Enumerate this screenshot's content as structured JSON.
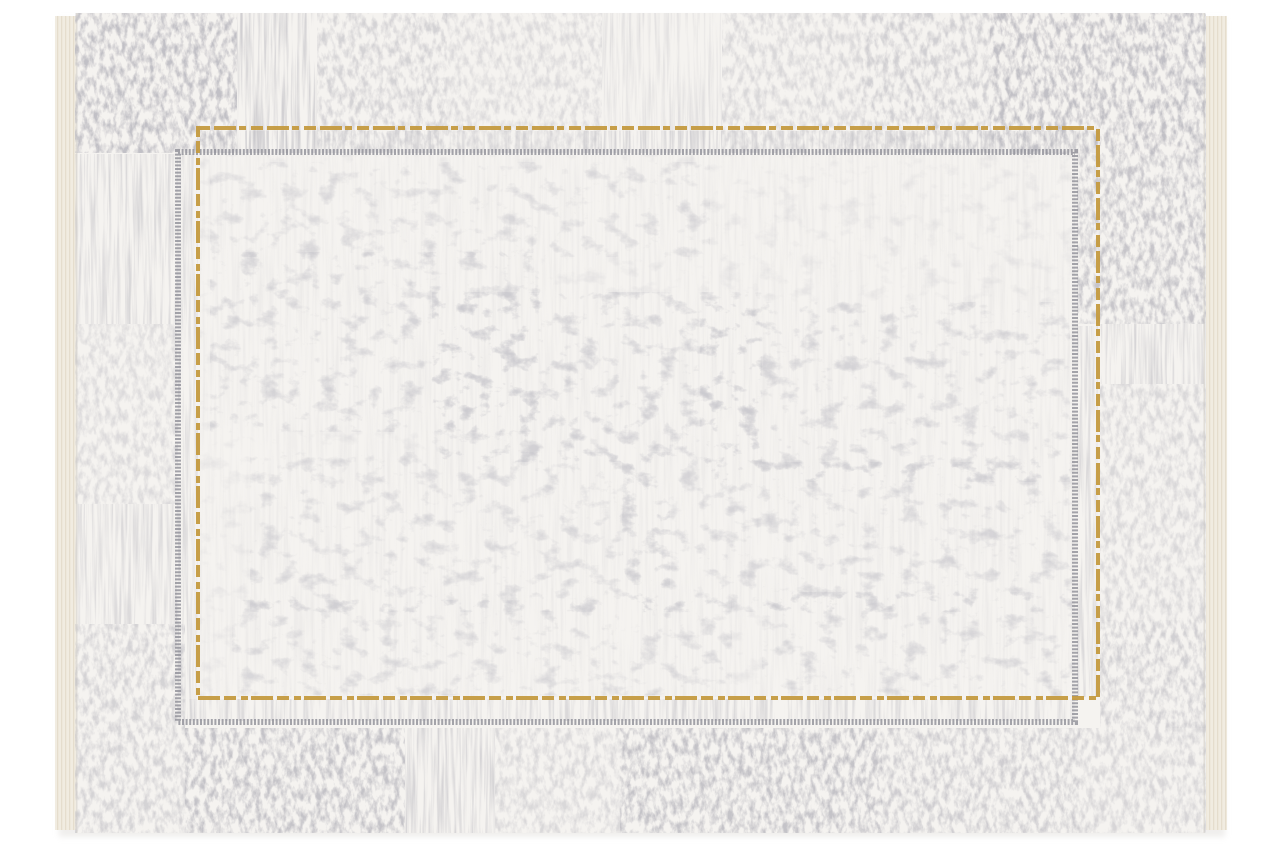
{
  "image": {
    "description": "Product photograph of a modern distressed-style area rug on a white background. Cream-white rug with abstract faded grey patchwork border texture, an inner field framed by a thin dashed gold rectangle and an offset dashed grey rectangle, with cream fringe selvedge bands on the left and right edges.",
    "width": 1280,
    "height": 853,
    "background_color": "#ffffff"
  },
  "palette": {
    "rug_base": "#f5f3f0",
    "field_base": "#f3f1ee",
    "fringe_cream": "#f1ece1",
    "fringe_rib": "#e2dac8",
    "edge_seam": "#dcd8d2",
    "texture_grey_dark": "#85838c",
    "texture_grey_mid": "#8a8890",
    "texture_grey_light": "#94929b",
    "gold_accent": "#c49a3f",
    "grey_frame": "#8f8f97",
    "shadow": "#e3e1de"
  },
  "rug": {
    "x": 55,
    "y": 13,
    "width": 1172,
    "height": 820,
    "pile": {
      "x": 76,
      "y": 13,
      "width": 1129,
      "height": 820,
      "base_color": "#f5f3f0"
    },
    "fringe": {
      "left_x": 55,
      "right_x": 1206,
      "width": 21,
      "y": 16,
      "height": 814,
      "color": "#f1ece1",
      "rib_color": "#e2dac8"
    },
    "seam_color": "#dcd8d2",
    "frames": {
      "gold": {
        "x": 198,
        "y": 128,
        "width": 900,
        "height": 570,
        "stroke_width": 4,
        "color": "#c49a3f",
        "dash": "12 4 22 3 7 5",
        "opacity": 0.95
      },
      "grey": {
        "x": 178,
        "y": 152,
        "width": 897,
        "height": 570,
        "stroke_width": 6,
        "color": "#8f8f97",
        "dash": "2 1.6",
        "opacity": 0.8
      }
    },
    "textures": {
      "threads": {
        "base_frequency": "0.35 0.012",
        "octaves": 3,
        "seed": 11,
        "color": "#8a8890",
        "alpha_gain": 2.6,
        "alpha_bias": -1.05
      },
      "cross": {
        "base_frequency": "0.18 0.09",
        "octaves": 4,
        "seed": 7,
        "color": "#85838c",
        "alpha_gain": 2.8,
        "alpha_bias": -1.1
      },
      "speck": {
        "base_frequency": "0.05 0.07",
        "octaves": 5,
        "seed": 3,
        "color": "#94929b",
        "alpha_gain": 3.5,
        "alpha_bias": -1.9
      }
    },
    "border_patches": [
      {
        "x": 75,
        "y": 13,
        "w": 162,
        "h": 140,
        "texture": "cross",
        "opacity": 0.95
      },
      {
        "x": 237,
        "y": 13,
        "w": 80,
        "h": 140,
        "texture": "threads",
        "opacity": 0.7
      },
      {
        "x": 317,
        "y": 13,
        "w": 130,
        "h": 140,
        "texture": "cross",
        "opacity": 0.6
      },
      {
        "x": 447,
        "y": 13,
        "w": 155,
        "h": 140,
        "texture": "cross",
        "opacity": 0.45
      },
      {
        "x": 602,
        "y": 13,
        "w": 120,
        "h": 140,
        "texture": "threads",
        "opacity": 0.4
      },
      {
        "x": 722,
        "y": 13,
        "w": 140,
        "h": 140,
        "texture": "cross",
        "opacity": 0.5
      },
      {
        "x": 862,
        "y": 13,
        "w": 128,
        "h": 140,
        "texture": "cross",
        "opacity": 0.65
      },
      {
        "x": 990,
        "y": 13,
        "w": 216,
        "h": 141,
        "texture": "cross",
        "opacity": 0.95
      },
      {
        "x": 1077,
        "y": 154,
        "w": 129,
        "h": 170,
        "texture": "cross",
        "opacity": 0.85
      },
      {
        "x": 1100,
        "y": 324,
        "w": 106,
        "h": 60,
        "texture": "threads",
        "opacity": 0.6
      },
      {
        "x": 1100,
        "y": 384,
        "w": 106,
        "h": 236,
        "texture": "cross",
        "opacity": 0.5
      },
      {
        "x": 1100,
        "y": 620,
        "w": 106,
        "h": 108,
        "texture": "cross",
        "opacity": 0.65
      },
      {
        "x": 75,
        "y": 154,
        "w": 103,
        "h": 170,
        "texture": "threads",
        "opacity": 0.55
      },
      {
        "x": 75,
        "y": 324,
        "w": 103,
        "h": 180,
        "texture": "cross",
        "opacity": 0.45
      },
      {
        "x": 75,
        "y": 504,
        "w": 103,
        "h": 120,
        "texture": "threads",
        "opacity": 0.5
      },
      {
        "x": 75,
        "y": 624,
        "w": 110,
        "h": 104,
        "texture": "cross",
        "opacity": 0.6
      },
      {
        "x": 75,
        "y": 728,
        "w": 110,
        "h": 105,
        "texture": "cross",
        "opacity": 0.6
      },
      {
        "x": 185,
        "y": 728,
        "w": 220,
        "h": 105,
        "texture": "cross",
        "opacity": 0.9
      },
      {
        "x": 405,
        "y": 728,
        "w": 90,
        "h": 105,
        "texture": "threads",
        "opacity": 0.65
      },
      {
        "x": 495,
        "y": 728,
        "w": 125,
        "h": 105,
        "texture": "cross",
        "opacity": 0.5
      },
      {
        "x": 620,
        "y": 728,
        "w": 262,
        "h": 105,
        "texture": "cross",
        "opacity": 0.9
      },
      {
        "x": 882,
        "y": 728,
        "w": 198,
        "h": 105,
        "texture": "cross",
        "opacity": 0.7
      },
      {
        "x": 1080,
        "y": 728,
        "w": 126,
        "h": 105,
        "texture": "cross",
        "opacity": 0.55
      },
      {
        "x": 200,
        "y": 131,
        "w": 898,
        "h": 22,
        "texture": "threads",
        "opacity": 0.5
      },
      {
        "x": 178,
        "y": 154,
        "w": 20,
        "h": 566,
        "texture": "threads",
        "opacity": 0.5
      },
      {
        "x": 1077,
        "y": 326,
        "w": 21,
        "h": 371,
        "texture": "threads",
        "opacity": 0.55
      },
      {
        "x": 180,
        "y": 699,
        "w": 895,
        "h": 22,
        "texture": "threads",
        "opacity": 0.5
      }
    ],
    "field_clusters": [
      {
        "x": 200,
        "y": 155,
        "w": 875,
        "h": 542,
        "texture": "speck",
        "opacity": 0.3
      },
      {
        "x": 200,
        "y": 155,
        "w": 875,
        "h": 542,
        "texture": "threads",
        "opacity": 0.14
      },
      {
        "x": 210,
        "y": 162,
        "w": 500,
        "h": 95,
        "texture": "speck",
        "opacity": 0.4
      },
      {
        "x": 210,
        "y": 252,
        "w": 330,
        "h": 180,
        "texture": "speck",
        "opacity": 0.55
      },
      {
        "x": 432,
        "y": 292,
        "w": 330,
        "h": 170,
        "texture": "speck",
        "opacity": 0.65
      },
      {
        "x": 700,
        "y": 302,
        "w": 370,
        "h": 180,
        "texture": "speck",
        "opacity": 0.55
      },
      {
        "x": 250,
        "y": 452,
        "w": 420,
        "h": 160,
        "texture": "speck",
        "opacity": 0.45
      },
      {
        "x": 622,
        "y": 462,
        "w": 450,
        "h": 150,
        "texture": "speck",
        "opacity": 0.5
      },
      {
        "x": 232,
        "y": 600,
        "w": 500,
        "h": 95,
        "texture": "speck",
        "opacity": 0.45
      },
      {
        "x": 762,
        "y": 592,
        "w": 310,
        "h": 105,
        "texture": "speck",
        "opacity": 0.5
      }
    ]
  }
}
